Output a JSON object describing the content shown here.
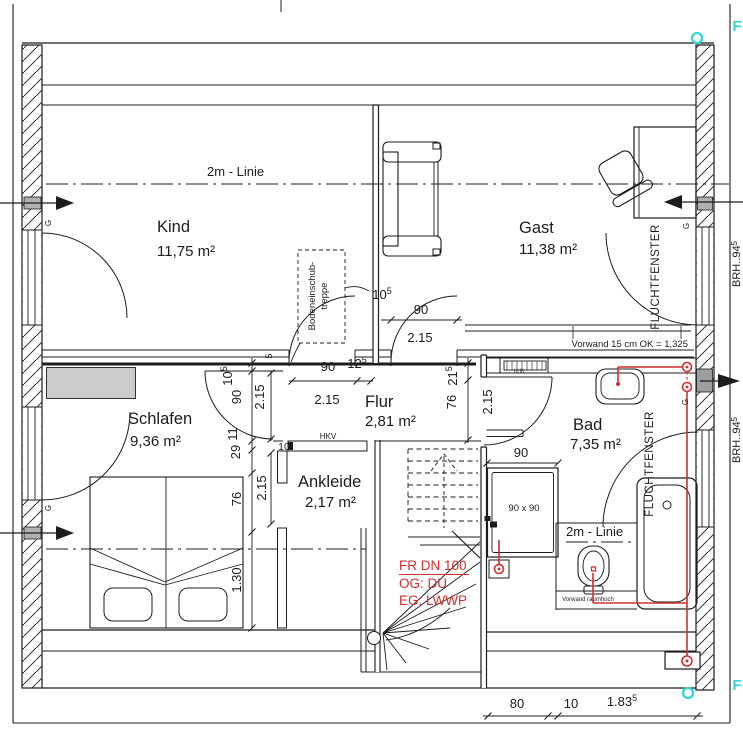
{
  "title": "Obergeschoss Grundriss (floor plan)",
  "colors": {
    "line": "#1c1c1c",
    "red": "#d32f2f",
    "cyan": "#2fd6d6",
    "gray_marker": "#b0b0b0",
    "gray_furniture": "#cbcbcb"
  },
  "rooms": {
    "kind": {
      "name": "Kind",
      "area": "11,75 m²"
    },
    "gast": {
      "name": "Gast",
      "area": "11,38 m²"
    },
    "schlafen": {
      "name": "Schlafen",
      "area": "9,36 m²"
    },
    "flur": {
      "name": "Flur",
      "area": "2,81 m²"
    },
    "ankleide": {
      "name": "Ankleide",
      "area": "2,17 m²"
    },
    "bad": {
      "name": "Bad",
      "area": "7,35 m²"
    }
  },
  "ann": {
    "line2m": "2m - Linie",
    "bodentreppe_l1": "Bodeneinschub-",
    "bodentreppe_l2": "treppe",
    "fluchtfenster": "FLUCHTFENSTER",
    "vorwand_ok": "Vorwand 15 cm OK = 1,325",
    "vorwand_raumhoch": "Vorwand raumhoch",
    "hkv": "HKV",
    "hhk": "HHK",
    "shower_size": "90 x 90",
    "window_handle": "G",
    "brh_left": "BRH..94",
    "brh_right_m": "BRH..94",
    "brh_right_s": "5",
    "f_marker": "F",
    "red_l1": "FR DN 100",
    "red_l2": "OG: DU",
    "red_l3": "EG: LWWP"
  },
  "dims": {
    "kd_w": "90",
    "kd_jamb_m": "12",
    "kd_jamb_s": "5",
    "kd_h": "2.15",
    "gd_off_m": "10",
    "gd_off_s": "5",
    "gd_w": "90",
    "gd_h": "2.15",
    "bd_h": "2.15",
    "sd_h": "2.15",
    "ank_h": "2.15",
    "lc_a_m": "10",
    "lc_a_s": "5",
    "lc_b": "90",
    "lc_c": "11",
    "lc_d": "29",
    "lc_e": "76",
    "lc_f": "1.30",
    "mc_a_m": "21",
    "mc_a_s": "5",
    "mc_b": "76",
    "pier_w": "10",
    "shower_w": "90",
    "bot_a": "80",
    "bot_b": "10",
    "bot_c_m": "1.83",
    "bot_c_s": "5",
    "tick5": "5"
  }
}
